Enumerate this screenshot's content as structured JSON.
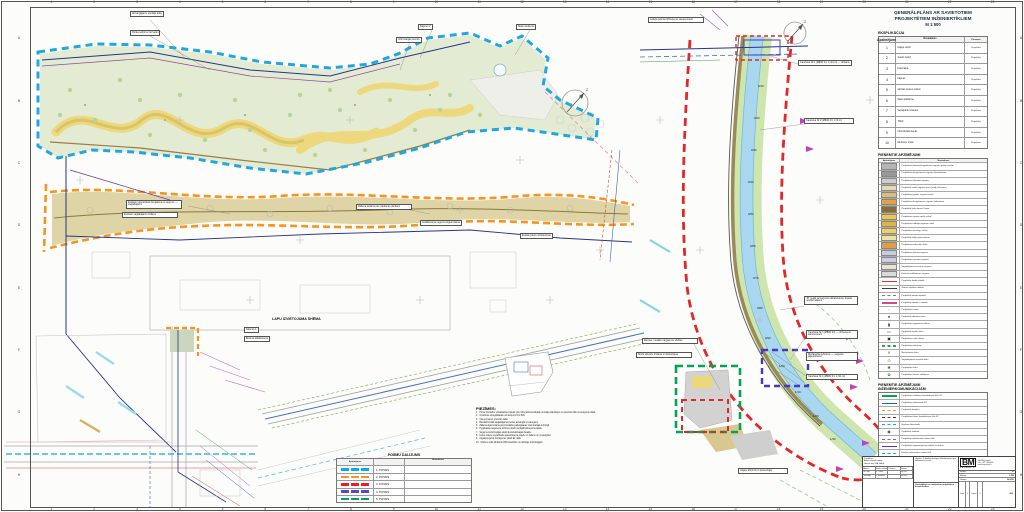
{
  "colors": {
    "boundary_cyan": "#1fa7e0",
    "boundary_orange": "#f7941d",
    "boundary_red": "#e02828",
    "boundary_green": "#00a651",
    "boundary_violet": "#4836c8",
    "water": "#a9d7ef"
  },
  "frame": {
    "columns": [
      "1",
      "2",
      "3",
      "4",
      "5",
      "6",
      "7",
      "8",
      "9",
      "10",
      "11",
      "12",
      "13",
      "14",
      "15",
      "16",
      "17",
      "18",
      "19",
      "20",
      "21",
      "22",
      "23"
    ],
    "rows": [
      "A",
      "B",
      "C",
      "D",
      "E",
      "F",
      "G",
      "H"
    ]
  },
  "panel": {
    "title": "ĢENERĀLPLĀNS AR SAVIETOTIEM PROJEKTĒTIEM INŽENIERTĪKLIEM",
    "scale": "M 1:500",
    "explikacija": {
      "title": "EKSPLIKĀCIJA",
      "headers": [
        "Apzīmējums",
        "Nosaukums",
        "Piezīmes"
      ],
      "rows": [
        {
          "num": "1",
          "name": "Gājēju celiņš",
          "note": "Projektēts"
        },
        {
          "num": "2",
          "name": "Grants celiņš",
          "note": "Projektēts"
        },
        {
          "num": "3",
          "name": "Koka laipa",
          "note": "Projektēts"
        },
        {
          "num": "4",
          "name": "Kāpnes",
          "note": "Projektēts"
        },
        {
          "num": "5",
          "name": "Atpūtas vieta ar soliem",
          "note": "Projektēts"
        },
        {
          "num": "6",
          "name": "Skatu platforma",
          "note": "Projektēts"
        },
        {
          "num": "7",
          "name": "Velosipēdu novietne",
          "note": "Projektēts"
        },
        {
          "num": "8",
          "name": "Tiltiņš",
          "note": "Projektēts"
        },
        {
          "num": "9",
          "name": "Informācijas stends",
          "note": "Projektēts"
        },
        {
          "num": "10",
          "name": "Atkritumu urnas",
          "note": "Projektēts"
        }
      ]
    },
    "legend1": {
      "title": "PIEŅEMTIE APZĪMĒJUMI",
      "headers": [
        "Apzīmējums",
        "Nosaukums"
      ],
      "rows": [
        {
          "t": "fill",
          "c": "#b5b5b5",
          "label": "Projektētais betona bruģakmens segums gājēju zonām"
        },
        {
          "t": "fill",
          "c": "#989898",
          "label": "Projektētais bruģakmens segums iebrauktuvēm"
        },
        {
          "t": "fill",
          "c": "#cdcdcd",
          "label": "Projektētais šķembu segums"
        },
        {
          "t": "fill",
          "c": "#ead9b0",
          "label": "Projektētā smilts seguma zona (rotaļu laukums)"
        },
        {
          "t": "fill",
          "c": "#d8c078",
          "label": "Projektētais grants seguma celiņš"
        },
        {
          "t": "fill",
          "c": "#e8a23c",
          "label": "Projektētais bruģakmens segums laukumiem"
        },
        {
          "t": "fill",
          "c": "#8a6c38",
          "label": "Projektētā koka terase / laipa"
        },
        {
          "t": "fill",
          "c": "#f0c840",
          "label": "Projektētais grants-smilts celiņš"
        },
        {
          "t": "fill",
          "c": "#e6b43e",
          "label": "Projektētais dabīgā seguma celiņš"
        },
        {
          "t": "fill",
          "c": "#f0d258",
          "label": "Projektētais pastaigu celiņš"
        },
        {
          "t": "fill",
          "c": "#efe49c",
          "label": "Projektētā zālāja atjaunošana"
        },
        {
          "t": "fill",
          "c": "#e0a040",
          "label": "Projektētais koka dēļu klājs"
        },
        {
          "t": "fill",
          "c": "#c6cedb",
          "label": "Projektētais betona segums"
        },
        {
          "t": "fill",
          "c": "#d2cae9",
          "label": "Projektētais gumijas segums"
        },
        {
          "t": "fill",
          "c": "#eae3d3",
          "label": "Saglabājamais esošais segums"
        },
        {
          "t": "fill",
          "c": "#dadada",
          "label": "Esošais asfaltbetona segums"
        },
        {
          "t": "line",
          "c": "#e03030",
          "label": "Projektēto darbu robeža"
        },
        {
          "t": "line",
          "c": "#404040",
          "label": "Zemes vienības robeža"
        },
        {
          "t": "dash",
          "c": "#808080",
          "label": "Projektētā betona apmale"
        },
        {
          "t": "line",
          "c": "#d04890",
          "label": "Projektētā apmale / nomale"
        },
        {
          "t": "sym",
          "c": "#333333",
          "g": "◦",
          "label": "Projektētais soliņš"
        },
        {
          "t": "sym",
          "c": "#333333",
          "g": "●",
          "label": "Projektētā atkritumu urna"
        },
        {
          "t": "sym",
          "c": "#333333",
          "g": "▮",
          "label": "Projektētais apgaismes balsts"
        },
        {
          "t": "sym",
          "c": "#555555",
          "g": "▭",
          "label": "Projektētā norāžu zīme"
        },
        {
          "t": "sym",
          "c": "#333333",
          "g": "▣",
          "label": "Projektētais velo statīvs"
        },
        {
          "t": "dash",
          "c": "#30a048",
          "label": "Projektētais dzīvžogs"
        },
        {
          "t": "sym",
          "c": "#c03030",
          "g": "✕",
          "label": "Nocērtamais koks"
        },
        {
          "t": "sym",
          "c": "#3a7a3a",
          "g": "⊙",
          "label": "Saglabājamais esošais koks"
        },
        {
          "t": "sym",
          "c": "#3a7a3a",
          "g": "✱",
          "label": "Projektētais koks"
        },
        {
          "t": "sym",
          "c": "#3a7a3a",
          "g": "✿",
          "label": "Projektētais krūmu stādījums"
        }
      ]
    },
    "legend2": {
      "title": "PIEŅEMTIE APZĪMĒJUMI",
      "subtitle": "INŽENIERKOMUNIKĀCIJĀM",
      "rows": [
        {
          "t": "line",
          "c": "#00a651",
          "label": "Projektētais sadzīves kanalizācijas tīkls K1"
        },
        {
          "t": "line",
          "c": "#0070c0",
          "label": "Projektētais ūdensvads Ū1"
        },
        {
          "t": "dash",
          "c": "#f7941d",
          "label": "Projektētā drenāža"
        },
        {
          "t": "dash",
          "c": "#404040",
          "label": "Projektētais lietus kanalizācijas tīkls K2"
        },
        {
          "t": "dash",
          "c": "#00b0f0",
          "label": "Esošais ūdensvads"
        },
        {
          "t": "sym",
          "c": "#203080",
          "g": "◉",
          "label": "Projektētā skataka"
        },
        {
          "t": "dash",
          "c": "#c040c0",
          "label": "Projektētie elektronisko sakaru tīkli"
        },
        {
          "t": "line",
          "c": "#7030a0",
          "label": "Projektētais apgaismojuma kabelis un balsts"
        },
        {
          "t": "dash",
          "c": "#00c0c0",
          "label": "Esošie elektronisko sakaru tīkli"
        },
        {
          "t": "dot",
          "c": "#4472c4",
          "label": "Esošā lietus kanalizācija"
        },
        {
          "t": "sym",
          "c": "#203080",
          "g": "⊢",
          "label": "Projektētais hidrants"
        },
        {
          "t": "line",
          "c": "#2a3a9a",
          "label": "Tīrāmais novadgrāvis"
        }
      ]
    }
  },
  "notes": {
    "title": "PIEZĪMES:",
    "items": [
      "Pirms būvdarbu uzsākšanas izsaukt visu inženierkomunikāciju turētāju pārstāvjus un precizēt tīklu novietojumu dabā.",
      "Izmantots topogrāfiskais uzmērījums M 1:500.",
      "Visus izmērus precizēt dabā.",
      "Būvdarbu laikā saglabājamos kokus aizsargāt ar vairogiem.",
      "Zāliena atjaunošana pēc būvdarbu pabeigšanas visā skartajā teritorijā.",
      "Projektētās augstuma atzīmes skatīt vertikālā plānojuma lapās.",
      "Segumu konstrukcijas skatīt konstruktīvajās detaļās.",
      "Lietus ūdens novadīšana paredzēta pa reljefu uz zālienu un novadgrāvi.",
      "Apgaismojuma risinājumus skatīt EL daļā.",
      "Darbus veikt atbilstoši LBN prasībām un ražotāju tehnoloģijām."
    ]
  },
  "posmi": {
    "title": "POSMU DALĪJUMS",
    "headers": [
      "Apzīmējums",
      "Nosaukums"
    ],
    "rows": [
      {
        "c": "#00aeef",
        "label": "1. POSMS"
      },
      {
        "c": "#f7941d",
        "label": "2. POSMS"
      },
      {
        "c": "#ed1c24",
        "label": "3. POSMS"
      },
      {
        "c": "#5a45d0",
        "label": "4. POSMS"
      },
      {
        "c": "#00a651",
        "label": "5. POSMS"
      }
    ]
  },
  "map": {
    "schema_title": "LAPU IZVIETOJUMA SHĒMA",
    "north_label": "Z",
    "callouts": [
      {
        "x": 130,
        "y": 11,
        "t": "Aizsargājams esošais koks"
      },
      {
        "x": 130,
        "y": 30,
        "t": "Parka soliņš ar atzveltni"
      },
      {
        "x": 396,
        "y": 37,
        "t": "Informācijas stends"
      },
      {
        "x": 418,
        "y": 24,
        "t": "Kāpnes 2"
      },
      {
        "x": 516,
        "y": 24,
        "t": "Skatu laukums"
      },
      {
        "x": 126,
        "y": 200,
        "w": 62,
        "t": "Esošais vēsturiskais bruģakmens segums — saglabājams"
      },
      {
        "x": 122,
        "y": 212,
        "w": 56,
        "t": "Esošais saglabājams zāliens"
      },
      {
        "x": 356,
        "y": 204,
        "w": 54,
        "t": "Zāliena sēšana pēc rakšanas darbiem"
      },
      {
        "x": 420,
        "y": 220,
        "t": "Asfaltbetona seguma atjaunošana"
      },
      {
        "x": 520,
        "y": 233,
        "t": "Esošā grants nobrauktuve"
      },
      {
        "x": 244,
        "y": 327,
        "t": "Kāpnes 1"
      },
      {
        "x": 244,
        "y": 336,
        "t": "Betona atbalstsiena"
      },
      {
        "x": 648,
        "y": 17,
        "w": 54,
        "t": "Grāvja posma tīrīšana no sanesumiem"
      },
      {
        "x": 798,
        "y": 60,
        "w": 50,
        "t": "Caurteka Nr.1 (Ø800 b/t, L=14 m) — tīrīšana"
      },
      {
        "x": 804,
        "y": 118,
        "w": 46,
        "t": "Caurteka Nr.2 (Ø600 b/t, L=9 m)"
      },
      {
        "x": 804,
        "y": 296,
        "w": 50,
        "t": "\"R\" veida armogrunts atbalstsiena, krasta nostiprinājums"
      },
      {
        "x": 806,
        "y": 330,
        "w": 48,
        "t": "Caurteka Nr.3 (Ø800 b/t) — tīrīšana no sanesumiem"
      },
      {
        "x": 806,
        "y": 352,
        "w": 48,
        "t": "Mežaparka iebrauce — seguma atjaunošana"
      },
      {
        "x": 806,
        "y": 374,
        "w": 48,
        "t": "Caurteka Nr.4 (Ø600 b/t, L=11 m)"
      },
      {
        "x": 642,
        "y": 338,
        "w": 52,
        "t": "Rampa, metāla margas pie slūžām"
      },
      {
        "x": 636,
        "y": 352,
        "w": 52,
        "t": "Slūžu aizvaru tīrīšana un krāsošana"
      },
      {
        "x": 738,
        "y": 468,
        "w": 46,
        "t": "Gājēju tiltiņš Nr.2 (koka klājs)"
      }
    ],
    "stations": [
      {
        "label": "0/10",
        "x": 758,
        "y": 84
      },
      {
        "label": "0/20",
        "x": 754,
        "y": 116
      },
      {
        "label": "0/30",
        "x": 751,
        "y": 148
      },
      {
        "label": "0/40",
        "x": 748,
        "y": 180
      },
      {
        "label": "0/50",
        "x": 748,
        "y": 212
      },
      {
        "label": "0/60",
        "x": 750,
        "y": 244
      },
      {
        "label": "0/70",
        "x": 753,
        "y": 276
      },
      {
        "label": "0/80",
        "x": 757,
        "y": 306
      },
      {
        "label": "0/90",
        "x": 765,
        "y": 336
      },
      {
        "label": "1/00",
        "x": 779,
        "y": 364
      },
      {
        "label": "1/10",
        "x": 795,
        "y": 390
      },
      {
        "label": "1/20",
        "x": 813,
        "y": 414
      },
      {
        "label": "1/30",
        "x": 830,
        "y": 437
      }
    ]
  },
  "titleblock": {
    "left_lines": [
      "Pasūtītājs:",
      "Ādažu novada dome",
      "Gaujas iela 33A, Ādaži"
    ],
    "sig_headers": [
      "Amats",
      "Vārds, uzvārds",
      "Paraksts",
      "Datums"
    ],
    "sig_rows": [
      [
        "GP vad.",
        "D. Ozols",
        "",
        "04.2021"
      ],
      [
        "Izstrādāja",
        "L. Krūmiņa",
        "",
        "04.2021"
      ]
    ],
    "object_label": "Objekts:",
    "object_text": "Publiskās ārtelpas labiekārtojums gar ūdensteces krastu",
    "drawing_title": "Ģenerālplāns ar savietotiem projektētiem inženiertīkliem",
    "logo": "BM",
    "logo_sub": "PROJEKTS",
    "addr_lines": [
      "SIA \"BM-projekts\"",
      "Tālr. +371 67000000",
      "www.bmprojekts.lv"
    ],
    "fields": [
      [
        "Stadija",
        "TP"
      ],
      [
        "Mērogs",
        "1:500"
      ],
      [
        "Datums",
        "04.2021"
      ]
    ],
    "pages": [
      [
        "Lapa",
        "1"
      ],
      [
        "Lapas",
        "1"
      ]
    ],
    "code": "A10"
  }
}
